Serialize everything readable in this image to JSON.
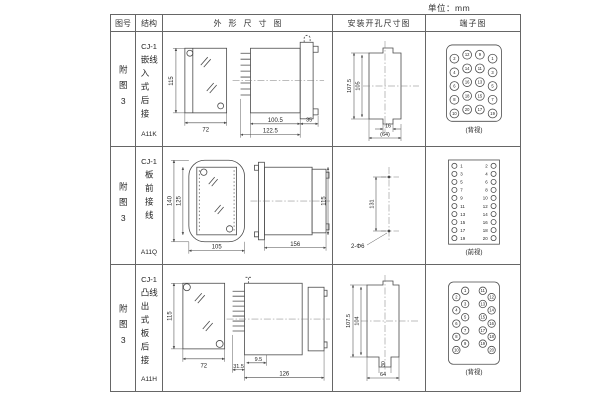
{
  "unit_label": "单位：mm",
  "headers": {
    "fig_no": "图号",
    "structure": "结构",
    "outline": "外形尺寸图",
    "install": "安装开孔尺寸图",
    "terminal": "端子图"
  },
  "rows": [
    {
      "fig_no": "附图3",
      "series": "CJ-1",
      "structure": "嵌入式后接线",
      "model": "A11K",
      "outline": {
        "front_height": "115",
        "front_width": "72",
        "body_length": "100.5",
        "total_length": "122.5",
        "flange_depth": "35"
      },
      "install": {
        "cutout_height": "107.5",
        "inner_height": "105",
        "tab_width": "16",
        "cutout_width": "(64)"
      },
      "terminal": {
        "view_label": "(背视)",
        "numbers": [
          "2",
          "12",
          "9",
          "1",
          "4",
          "14",
          "11",
          "3",
          "6",
          "16",
          "13",
          "5",
          "8",
          "18",
          "15",
          "7",
          "10",
          "20",
          "17",
          "19"
        ]
      }
    },
    {
      "fig_no": "附图3",
      "series": "CJ-1",
      "structure": "板前接线",
      "model": "A11Q",
      "outline": {
        "plate_height": "140",
        "inner_height": "125",
        "plate_width": "105",
        "body_length": "156",
        "body_height": "115"
      },
      "install": {
        "hole_spacing": "131",
        "hole_note": "2-Φ6"
      },
      "terminal": {
        "view_label": "(前视)",
        "left": [
          "1",
          "3",
          "5",
          "7",
          "9",
          "11",
          "13",
          "15",
          "17",
          "19"
        ],
        "right": [
          "2",
          "4",
          "6",
          "8",
          "10",
          "12",
          "14",
          "16",
          "18",
          "20"
        ]
      }
    },
    {
      "fig_no": "附图3",
      "series": "CJ-1",
      "structure": "凸出式板后接线",
      "model": "A11H",
      "outline": {
        "front_height": "115",
        "front_width": "72",
        "pin_length": "31.5",
        "offset": "9.5",
        "body_length": "126"
      },
      "install": {
        "cutout_height": "107.5",
        "inner_height": "104",
        "slot_width": "30",
        "cutout_width": "64"
      },
      "terminal": {
        "view_label": "(背视)",
        "numbers": [
          "1",
          "2",
          "3",
          "4",
          "5",
          "6",
          "7",
          "8",
          "9",
          "10",
          "11",
          "12",
          "13",
          "14",
          "15",
          "16",
          "17",
          "18",
          "19",
          "20"
        ]
      }
    }
  ]
}
